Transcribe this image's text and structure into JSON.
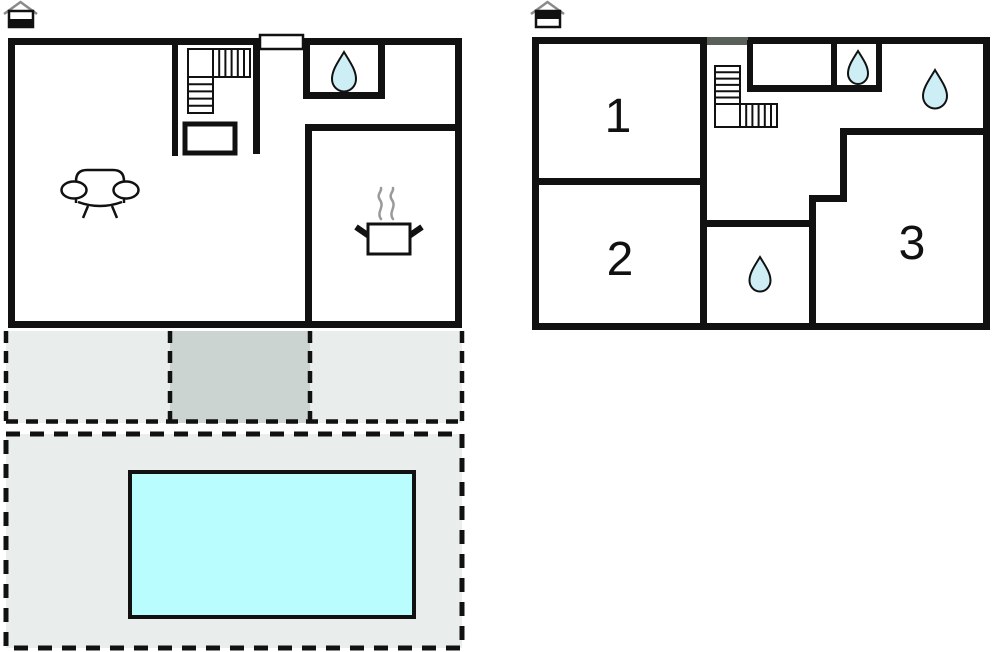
{
  "app": {
    "type": "vacation-home floor plan",
    "background": "#ffffff"
  },
  "colors": {
    "wall": "#111111",
    "pool_water": "#b9fdff",
    "patio_light": "#e9edec",
    "patio_dark": "#ccd4d2",
    "water_drop": "#cdeef5",
    "steam": "#9a9a9a",
    "wall_opening_gray": "#596059",
    "roof_gray": "#8a8a8a",
    "room_fill": "#ffffff"
  },
  "ground_floor": {
    "level_icon": "house-ground-floor-icon",
    "icons": [
      "stairs-icon",
      "entrance-door",
      "water-drop-icon",
      "sofa-icon",
      "cooking-pot-icon"
    ],
    "outdoor": [
      "patio-area",
      "covered-terrace",
      "pool-area",
      "swimming-pool"
    ]
  },
  "upper_floor": {
    "level_icon": "house-upper-floor-icon",
    "icons": [
      "stairs-icon",
      "water-drop-icon",
      "water-drop-icon",
      "water-drop-icon"
    ],
    "rooms": [
      {
        "label": "1"
      },
      {
        "label": "2"
      },
      {
        "label": "3"
      }
    ]
  }
}
